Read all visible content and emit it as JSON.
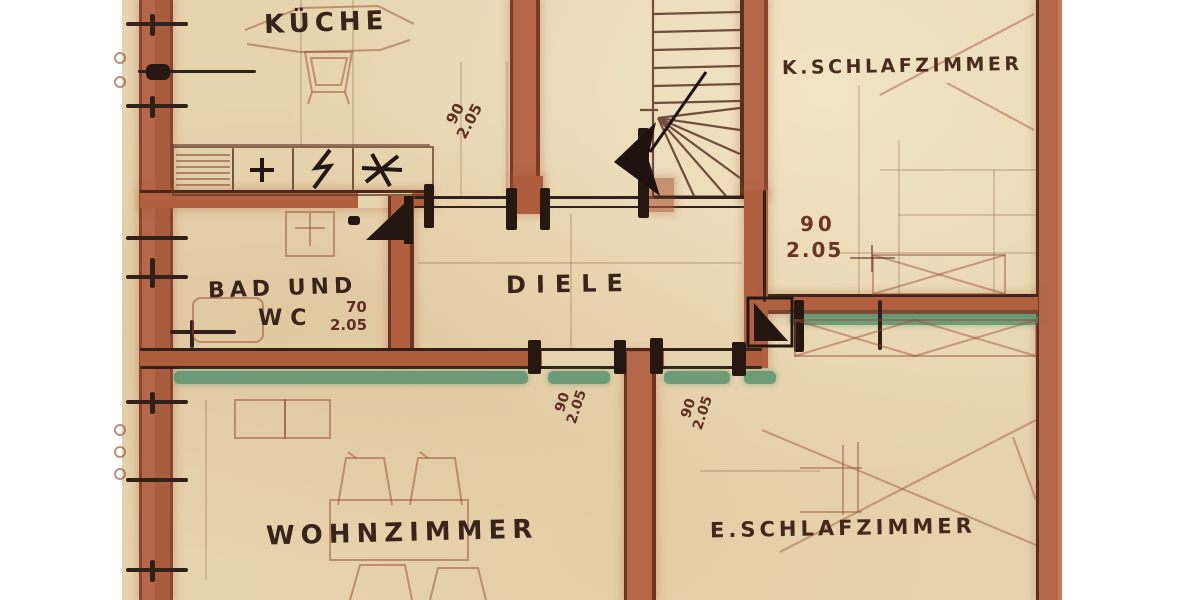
{
  "rooms": {
    "kueche": "KÜCHE",
    "k_schlafzimmer": "K.SCHLAFZIMMER",
    "bad_line1": "BAD UND",
    "bad_line2": "WC",
    "diele": "DIELE",
    "wohnzimmer": "WOHNZIMMER",
    "e_schlafzimmer": "E.SCHLAFZIMMER"
  },
  "door_dimensions": {
    "kueche_diele": {
      "width_cm": "90",
      "height_m": "2.05"
    },
    "bad": {
      "width_cm": "70",
      "height_m": "2.05"
    },
    "k_schlafzimmer": {
      "width_cm": "90",
      "height_m": "2.05"
    },
    "wohnzimmer": {
      "width_cm": "90",
      "height_m": "2.05"
    },
    "e_schlafzimmer": {
      "width_cm": "90",
      "height_m": "2.05"
    }
  },
  "colors": {
    "paper": "#e6d4ae",
    "wall_fill": "#b0603f",
    "wall_edge": "#6d3322",
    "ink": "#32201a",
    "dimension_text": "#5f3123",
    "window_green": "#53906c",
    "margin_white": "#ffffff"
  }
}
